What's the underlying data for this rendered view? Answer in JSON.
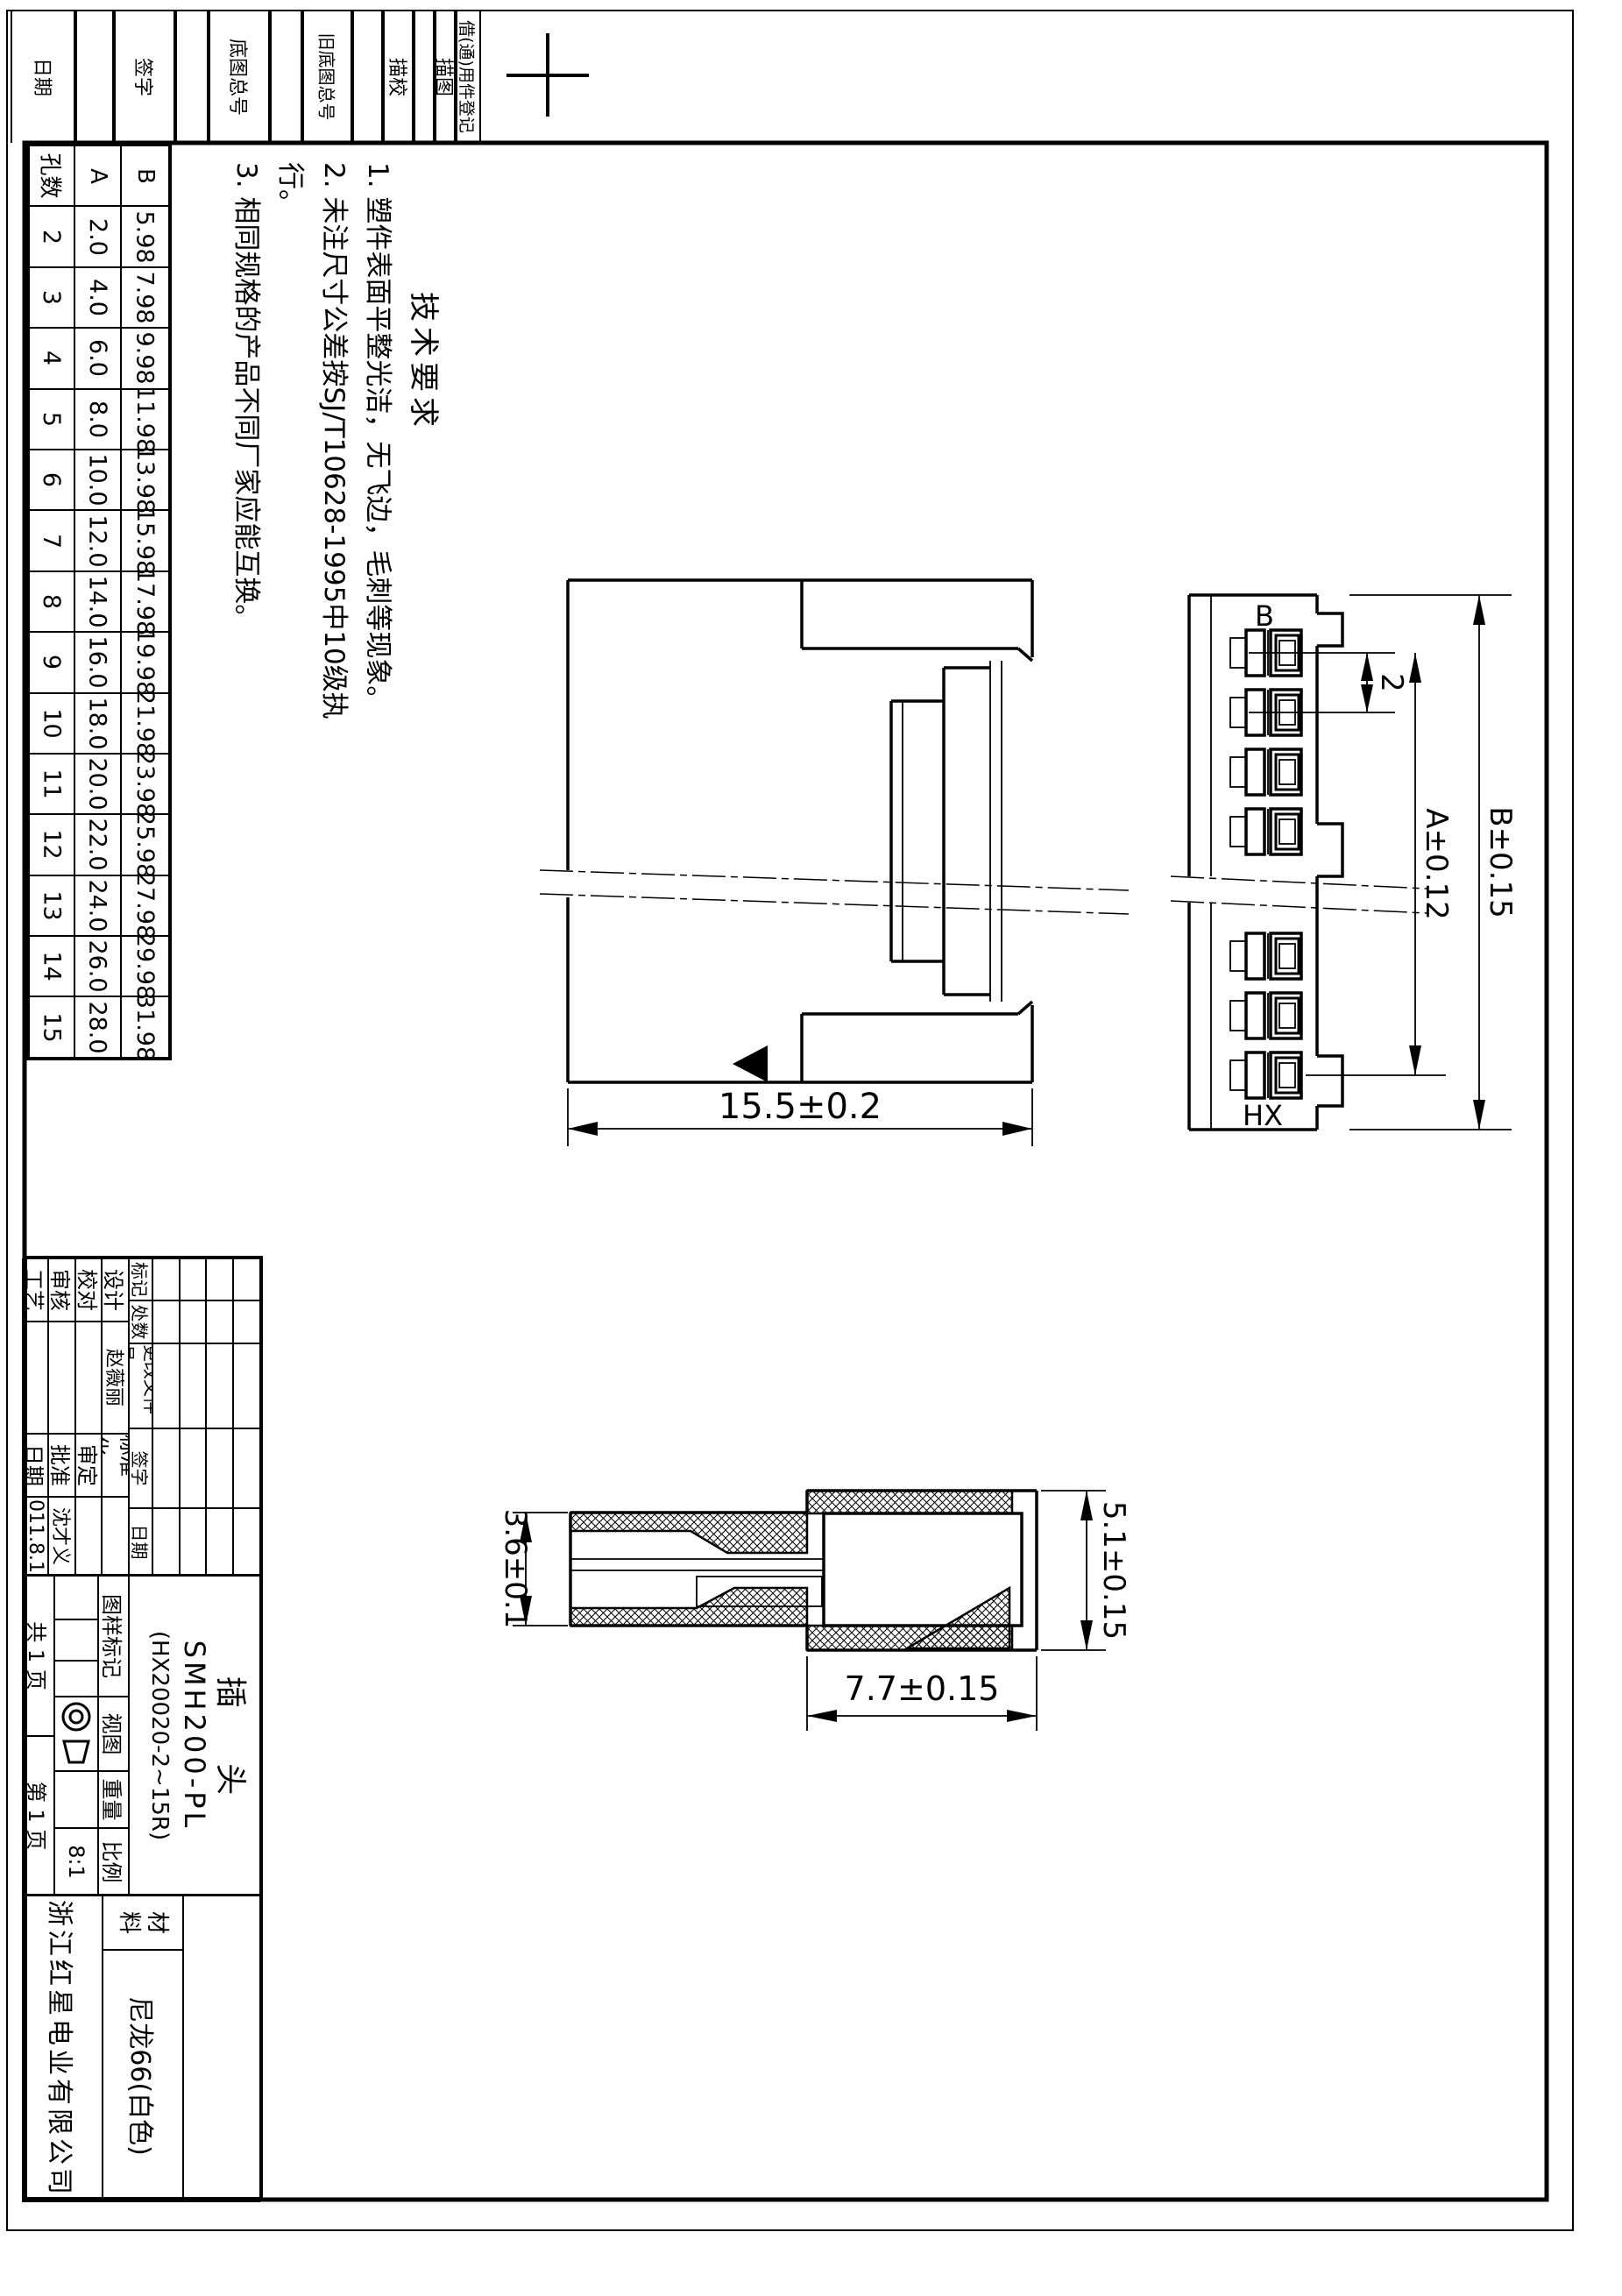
{
  "meta": {
    "ink": "#000000",
    "paper": "#ffffff",
    "sheet_type": "engineering-drawing"
  },
  "border_strip": {
    "labels": [
      "日期",
      "签字",
      "底图总号",
      "旧底图总号",
      "描校",
      "描图",
      "借(通)用件登记"
    ]
  },
  "hole_table": {
    "headers": [
      "孔数",
      "A",
      "B"
    ],
    "rows": [
      {
        "n": "2",
        "a": "2.0",
        "b": "5.98"
      },
      {
        "n": "3",
        "a": "4.0",
        "b": "7.98"
      },
      {
        "n": "4",
        "a": "6.0",
        "b": "9.98"
      },
      {
        "n": "5",
        "a": "8.0",
        "b": "11.98"
      },
      {
        "n": "6",
        "a": "10.0",
        "b": "13.98"
      },
      {
        "n": "7",
        "a": "12.0",
        "b": "15.98"
      },
      {
        "n": "8",
        "a": "14.0",
        "b": "17.98"
      },
      {
        "n": "9",
        "a": "16.0",
        "b": "19.98"
      },
      {
        "n": "10",
        "a": "18.0",
        "b": "21.98"
      },
      {
        "n": "11",
        "a": "20.0",
        "b": "23.98"
      },
      {
        "n": "12",
        "a": "22.0",
        "b": "25.98"
      },
      {
        "n": "13",
        "a": "24.0",
        "b": "27.98"
      },
      {
        "n": "14",
        "a": "26.0",
        "b": "29.98"
      },
      {
        "n": "15",
        "a": "28.0",
        "b": "31.98"
      }
    ]
  },
  "tech_req": {
    "title": "技术要求",
    "items": [
      "1. 塑件表面平整光洁，无飞边，毛刺等现象。",
      "2. 未注尺寸公差按SJ/T10628-1995中10级执行。",
      "3. 相同规格的产品不同厂家应能互换。"
    ]
  },
  "dims": {
    "main_width": "15.5±0.2",
    "pitch": "2",
    "dim_a": "A±0.12",
    "dim_b": "B±0.15",
    "sec_left": "3.6±0.1",
    "sec_right": "5.1±0.15",
    "sec_width": "7.7±0.15",
    "label_b": "B",
    "label_hx": "HX"
  },
  "title_block": {
    "rev_headers": [
      "标记",
      "处数",
      "更改文件号",
      "签字",
      "日期"
    ],
    "sig_rows": [
      {
        "label": "设计",
        "name": "赵薇丽",
        "label2": "标准化",
        "name2": ""
      },
      {
        "label": "校对",
        "name": "",
        "label2": "审定",
        "name2": ""
      },
      {
        "label": "审核",
        "name": "",
        "label2": "批准",
        "name2": "沈才义"
      },
      {
        "label": "工艺",
        "name": "",
        "label2": "日期",
        "name2": "2011.8.15"
      }
    ],
    "part_name": "插 头",
    "part_model": "SMH200-PL",
    "part_spec": "(HX20020-2~15R)",
    "mark_label": "图样标记",
    "view_label": "视图",
    "weight_label": "重量",
    "scale_label": "比例",
    "scale_value": "8:1",
    "pages_total": "共 1 页",
    "page_no": "第 1 页",
    "material_label": "材料",
    "material_value": "尼龙66(白色)",
    "company": "浙江红星电业有限公司"
  }
}
